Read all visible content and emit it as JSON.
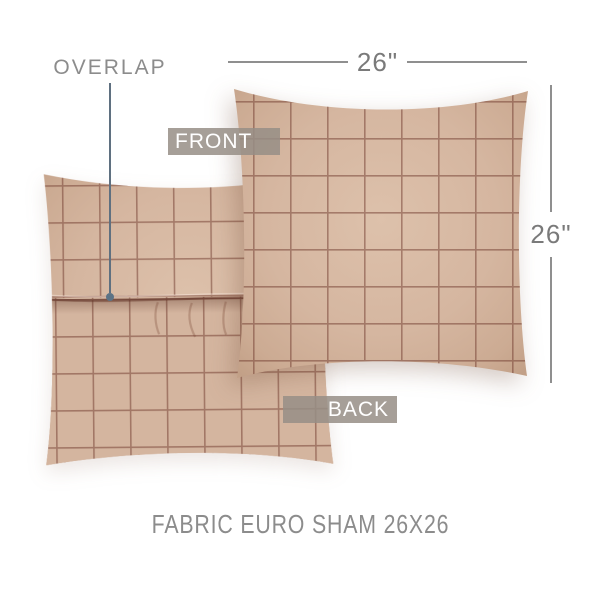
{
  "diagram": {
    "caption": "FABRIC EURO SHAM 26X26",
    "overlap_label": "OVERLAP",
    "front_label": "FRONT",
    "back_label": "BACK",
    "dimension_width": "26\"",
    "dimension_height": "26\"",
    "product": {
      "type": "euro sham pillow",
      "views": [
        "back with overlap closure",
        "front"
      ],
      "pattern": "windowpane check"
    },
    "colors": {
      "fabric": "#d5b6a0",
      "fabric_highlight": "#ddc1ab",
      "fabric_edge": "#c2a087",
      "check_line": "#6f3a2d",
      "label_box_bg": "#968e86",
      "label_text": "#ffffff",
      "annotation_text": "#8c8c8c",
      "dimension_line": "#8f8f8f",
      "leader_line": "#5f7080",
      "leader_dot": "#5c7285"
    }
  }
}
